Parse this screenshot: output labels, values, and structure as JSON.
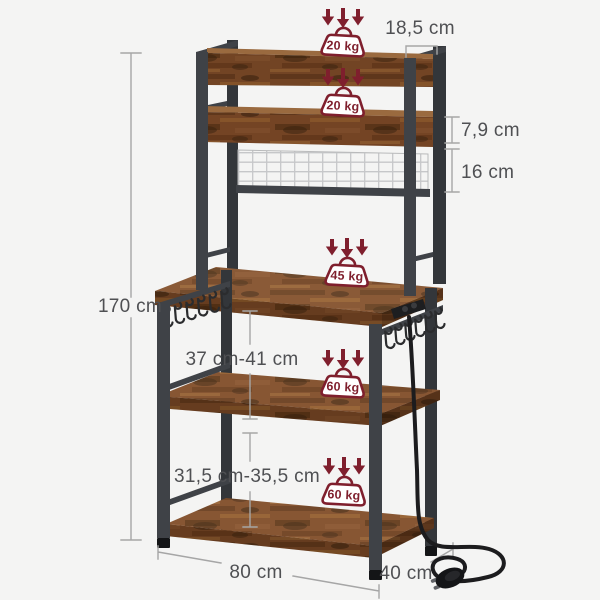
{
  "diagram": {
    "weights": {
      "top_shelf": "20 kg",
      "second_shelf": "20 kg",
      "tabletop": "45 kg",
      "middle_shelf": "60 kg",
      "bottom_shelf": "60 kg"
    },
    "dimensions": {
      "total_height": "170 cm",
      "top_shelf_depth": "18,5 cm",
      "shelf_lip_height": "7,9 cm",
      "mesh_panel_height": "16 cm",
      "tabletop_to_middle_shelf": "37 cm-41 cm",
      "middle_to_bottom_shelf": "31,5 cm-35,5 cm",
      "width": "80 cm",
      "depth": "40 cm"
    },
    "icons": {
      "weight_badge": "kettlebell-weight-icon",
      "load_direction": "triple-down-arrows-icon",
      "power": "power-cord-eu-plug-icon",
      "hooks": "s-hooks-icon"
    },
    "colors": {
      "accent_red": "#7f1f2d",
      "wood_brown": "#7d4a28",
      "metal_gray": "#3f4247",
      "dimension_line": "#a6a6a6",
      "dimension_text": "#4f5053",
      "background": "#f4f4f3"
    }
  }
}
